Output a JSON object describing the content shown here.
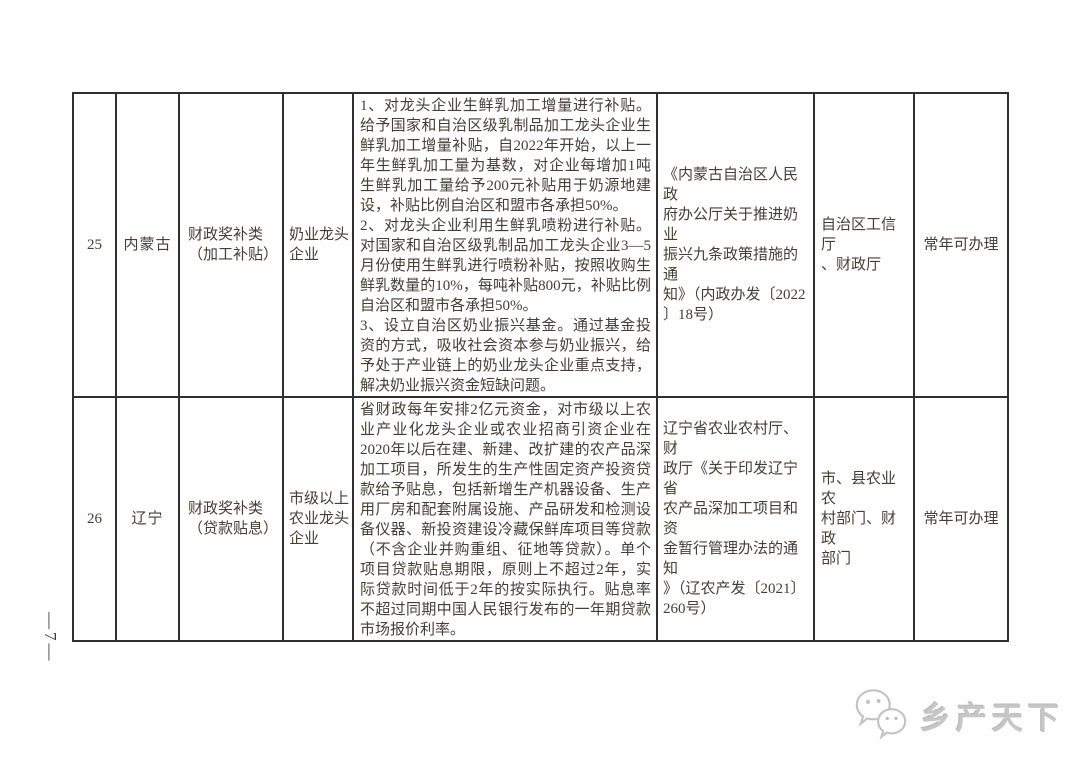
{
  "page": {
    "page_number": "—7—",
    "watermark_text": "乡产天下"
  },
  "colors": {
    "table_border": "#2f2f2f",
    "text": "#443e38",
    "watermark": "#c6c6c6",
    "background": "#fefefe"
  },
  "table": {
    "rows": [
      {
        "index": "25",
        "province": "内蒙古",
        "category": "财政奖补类（加工补贴）",
        "target": "奶业龙头企业",
        "policy_paragraphs": [
          "1、对龙头企业生鲜乳加工增量进行补贴。给予国家和自治区级乳制品加工龙头企业生鲜乳加工增量补贴，自2022年开始，以上一年生鲜乳加工量为基数，对企业每增加1吨生鲜乳加工量给予200元补贴用于奶源地建设，补贴比例自治区和盟市各承担50%。",
          "2、对龙头企业利用生鲜乳喷粉进行补贴。对国家和自治区级乳制品加工龙头企业3—5月份使用生鲜乳进行喷粉补贴，按照收购生鲜乳数量的10%，每吨补贴800元，补贴比例自治区和盟市各承担50%。",
          "3、设立自治区奶业振兴基金。通过基金投资的方式，吸收社会资本参与奶业振兴，给予处于产业链上的奶业龙头企业重点支持，解决奶业振兴资金短缺问题。"
        ],
        "document": "《内蒙古自治区人民政\n府办公厅关于推进奶业\n振兴九条政策措施的通\n知》（内政办发〔2022\n〕18号）",
        "departments": "自治区工信厅\n、财政厅",
        "availability": "常年可办理"
      },
      {
        "index": "26",
        "province": "辽宁",
        "category": "财政奖补类（贷款贴息）",
        "target": "市级以上农业龙头企业",
        "policy_paragraphs": [
          "省财政每年安排2亿元资金，对市级以上农业产业化龙头企业或农业招商引资企业在2020年以后在建、新建、改扩建的农产品深加工项目，所发生的生产性固定资产投资贷款给予贴息，包括新增生产机器设备、生产用厂房和配套附属设施、产品研发和检测设备仪器、新投资建设冷藏保鲜库项目等贷款（不含企业并购重组、征地等贷款）。单个项目贷款贴息期限，原则上不超过2年，实际贷款时间低于2年的按实际执行。贴息率不超过同期中国人民银行发布的一年期贷款市场报价利率。"
        ],
        "document": "辽宁省农业农村厅、财\n政厅《关于印发辽宁省\n农产品深加工项目和资\n金暂行管理办法的通知\n》（辽农产发〔2021〕\n260号）",
        "departments": "市、县农业农\n村部门、财政\n部门",
        "availability": "常年可办理"
      }
    ]
  }
}
